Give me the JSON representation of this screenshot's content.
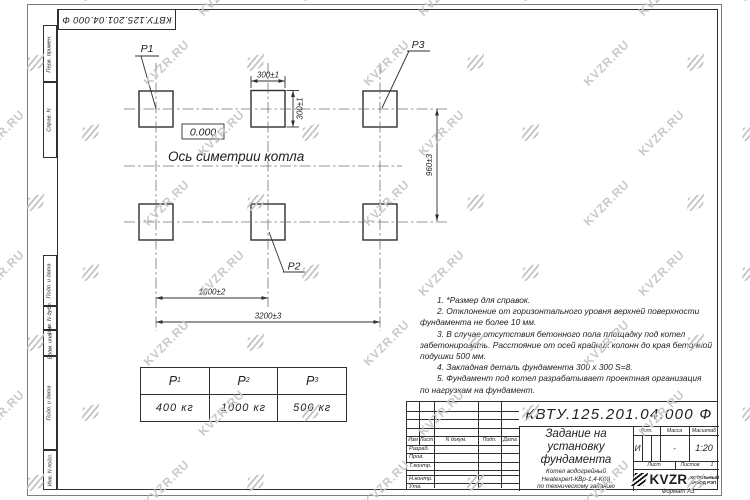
{
  "watermark": {
    "text": "KVZR.RU"
  },
  "top_stamp": {
    "text": "КВТУ.125.201.04.000 Ф"
  },
  "side_strip": {
    "cells": [
      "Перв. примен.",
      "Справ. N",
      "Подп. и дата",
      "Инв. N дубл.",
      "Взам. инв. N",
      "Подп. и дата",
      "Инв. N подл."
    ]
  },
  "drawing": {
    "point_labels": {
      "p1": "P1",
      "p2": "P2",
      "p3": "P3"
    },
    "elevation_label": "0.000",
    "axis_label": "Ось симетрии котла",
    "dims": {
      "w300": "300±1",
      "h300": "300±1",
      "v960": "960±3",
      "w1600": "1600±2",
      "w3200": "3200±3"
    }
  },
  "notes": {
    "lines": [
      "1. *Размер для справок.",
      "2. Отклонение от горизонтального уровня верхней поверхности",
      "фундамента не более 10 мм.",
      "3. В случае отсутствия бетонного пола площадку под котел",
      "забетонировать. Расстояние от осей крайних колонн до края бетонной",
      "подушки 500 мм.",
      "4. Закладная деталь фундамента  300 x 300  S=8.",
      "5. Фундамент под котел разрабатывает проектная организация",
      "по нагрузкам на фундамент."
    ]
  },
  "load_table": {
    "headers": [
      {
        "base": "P",
        "sub": "1"
      },
      {
        "base": "P",
        "sub": "2"
      },
      {
        "base": "P",
        "sub": "3"
      }
    ],
    "values": [
      "400 кг",
      "1000 кг",
      "500 кг"
    ]
  },
  "title_block": {
    "doc_number": "КВТУ.125.201.04.000 Ф",
    "title_line1": "Задание на",
    "title_line2": "установку",
    "title_line3": "фундамента",
    "product_line1": "Котел водогрейный",
    "product_line2": "Heatexpert-КВр-1,4-К(К)",
    "product_line3": "по техническому заданию",
    "cols": {
      "izm": "Изм",
      "list": "Лист",
      "doc": "N докум.",
      "podp": "Подп.",
      "data": "Дата"
    },
    "rows": [
      "Разраб.",
      "Пров.",
      "Т.контр.",
      "",
      "Н.контр.",
      "Утв."
    ],
    "lit_label": "Лит.",
    "mass_label": "Масса",
    "scale_label": "Масштаб",
    "lit_value": "И",
    "mass_value": "-",
    "scale_value": "1:20",
    "sheet_label": "Лист",
    "sheets_label": "Листов",
    "sheets_count": "1",
    "logo": {
      "name": "KVZR",
      "sub1": "КОТЕЛЬНЫЙ",
      "sub2": "ЗАВОД РЭП"
    },
    "format_label": "Формат А3"
  }
}
